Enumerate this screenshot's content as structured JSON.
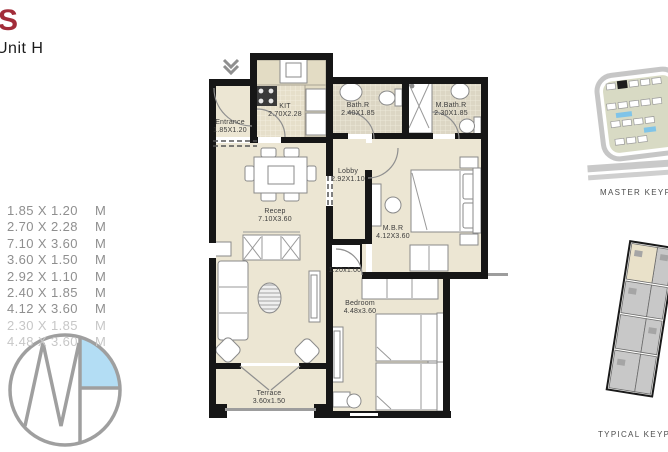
{
  "page": {
    "title_fragment": "S",
    "unit_label": "Unit H"
  },
  "dimensions": [
    {
      "size": "1.85 X 1.20",
      "unit": "M",
      "faded": false
    },
    {
      "size": "2.70 X 2.28",
      "unit": "M",
      "faded": false
    },
    {
      "size": "7.10 X 3.60",
      "unit": "M",
      "faded": false
    },
    {
      "size": "3.60 X 1.50",
      "unit": "M",
      "faded": false
    },
    {
      "size": "2.92 X 1.10",
      "unit": "M",
      "faded": false
    },
    {
      "size": "2.40 X 1.85",
      "unit": "M",
      "faded": false
    },
    {
      "size": "4.12 X 3.60",
      "unit": "M",
      "faded": false
    },
    {
      "size": "2.30 X 1.85",
      "unit": "M",
      "faded": true
    },
    {
      "size": "4.48 X 3.60",
      "unit": "M",
      "faded": true
    }
  ],
  "rooms": {
    "entrance": {
      "name": "Entrance",
      "dims": "1.85X1.20"
    },
    "kitchen": {
      "name": "KIT",
      "dims": "2.70X2.28"
    },
    "bath": {
      "name": "Bath.R",
      "dims": "2.40X1.85"
    },
    "master_bath": {
      "name": "M.Bath.R",
      "dims": "2.30X1.85"
    },
    "lobby": {
      "name": "Lobby",
      "dims": "2.92X1.10"
    },
    "reception": {
      "name": "Recep",
      "dims": "7.10X3.60"
    },
    "master_bedroom": {
      "name": "M.B.R",
      "dims": "4.12X3.60"
    },
    "bedroom": {
      "name": "Bedroom",
      "dims": "4.48x3.60"
    },
    "terrace": {
      "name": "Terrace",
      "dims": "3.60x1.50"
    },
    "shaft": {
      "name": "",
      "dims": "1.20x1.00"
    }
  },
  "keyplans": {
    "master_caption": "MASTER KEYPLAN",
    "typical_caption": "TYPICAL KEYPLAN"
  },
  "icons": {
    "entrance_arrow": "chevron-down-double",
    "logo": "mh-circle-monogram"
  },
  "colors": {
    "accent_red": "#a22c39",
    "wall_black": "#161616",
    "floor_beige": "#ece6d3",
    "tile_gray": "#dcd6c4",
    "highlight_blue": "#a6d8f3",
    "keyplan_green": "#b2b689",
    "pool_blue": "#7fc4e8",
    "logo_gray": "#8f8f8f"
  }
}
